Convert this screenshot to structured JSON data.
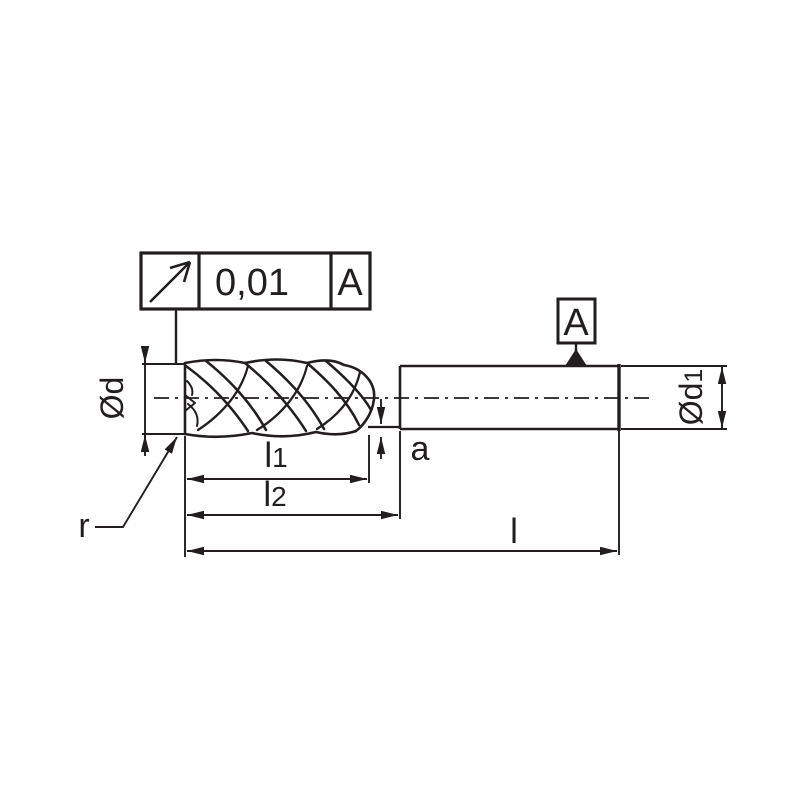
{
  "drawing": {
    "title": "end-mill dimension drawing",
    "tolerance_frame": {
      "symbol": "circular-runout-arrow",
      "value": "0,01",
      "datum_ref": "A"
    },
    "datum_flag": {
      "letter": "A"
    },
    "labels": {
      "cutting_diameter": {
        "base": "Ød"
      },
      "shank_diameter": {
        "base": "Ød",
        "sub": "1"
      },
      "flute_length": {
        "base": "l",
        "sub": "1"
      },
      "neck_length": {
        "base": "l",
        "sub": "2"
      },
      "overall_length": {
        "base": "l"
      },
      "radial_step": "a",
      "corner_radius": "r"
    },
    "colors": {
      "ink": "#221e20",
      "background": "#ffffff"
    }
  }
}
